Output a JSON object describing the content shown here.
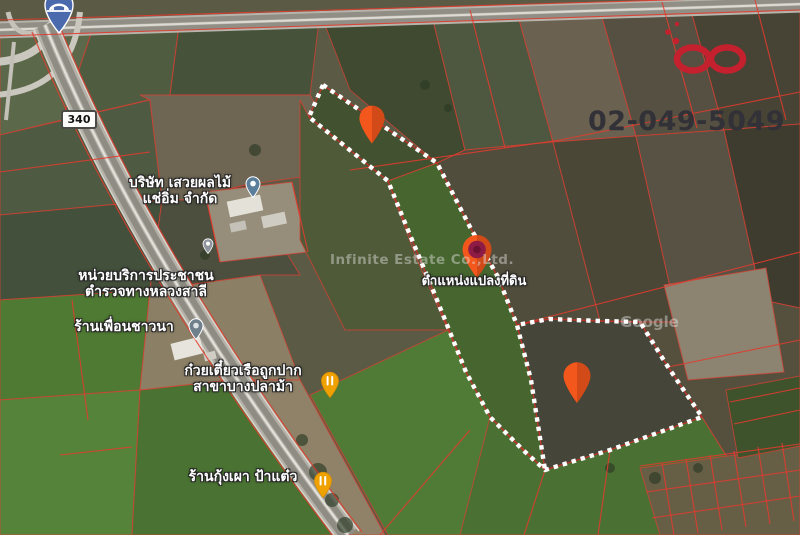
{
  "contact": {
    "phone": "02-049-5049"
  },
  "branding": {
    "watermark": "Infinite Estate Co.,Ltd.",
    "map_credit": "Google"
  },
  "map": {
    "road_badge": "340",
    "parcel_marker_label": "ตำแหน่งแปลงที่ดิน",
    "places": [
      {
        "line1": "บริษัท เสวยผลไม้",
        "line2": "แช่อิ่ม จำกัด"
      },
      {
        "line1": "หน่วยบริการประชาชน",
        "line2": "ตำรวจทางหลวงสาลี"
      },
      {
        "line1": "ร้านเพื่อนชาวนา",
        "line2": ""
      },
      {
        "line1": "ก๋วยเตี๋ยวเรือถูกปาก",
        "line2": "สาขาบางปลาม้า"
      },
      {
        "line1": "ร้านกุ้งเผา ป้าแต๋ว",
        "line2": ""
      }
    ],
    "colors": {
      "parcel_line_red": "#e23b2e",
      "boundary_dash_white": "#ffffff",
      "marker_orange": "#f4581d",
      "marker_core_maroon": "#8d1b45",
      "restaurant_pin_amber": "#efa100",
      "place_pin_blue_gray": "#5b7e9b",
      "logo_red": "#c5202e"
    }
  }
}
